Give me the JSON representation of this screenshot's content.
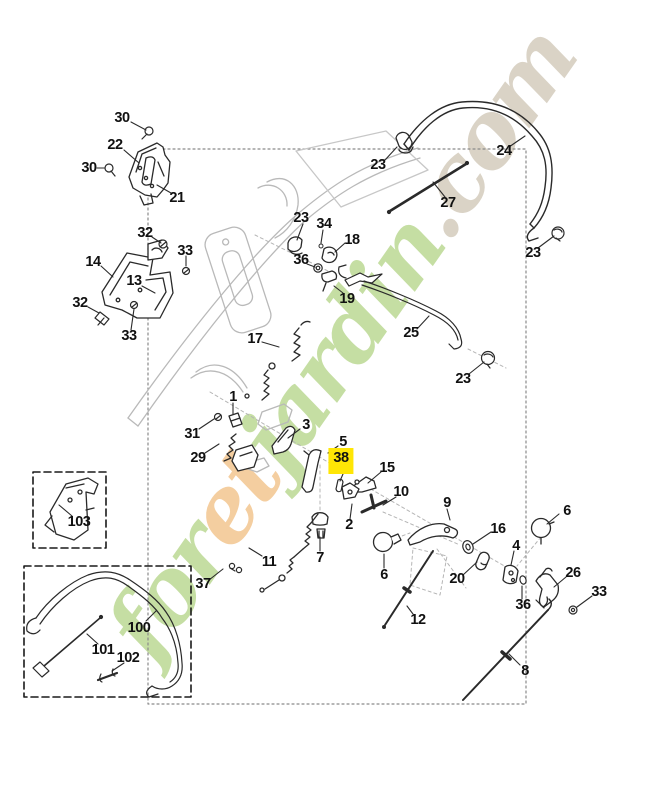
{
  "document": {
    "type": "exploded-parts-diagram",
    "subject": "lawnmower handle controls assembly"
  },
  "watermark": {
    "segments": [
      {
        "text": "for",
        "color": "#bcd994"
      },
      {
        "text": "et",
        "color": "#f3c690"
      },
      {
        "text": "jardin",
        "color": "#bcd994"
      },
      {
        "text": ".com",
        "color": "#d4ccbd"
      }
    ]
  },
  "colors": {
    "highlight": "#ffe605",
    "line": "#2a2a2a",
    "ghost": "#b7b7b7",
    "dashed_box": "#1a1a1a",
    "dotted_box": "#8a8a8a"
  },
  "diagram": {
    "highlighted_part": "38",
    "callouts": [
      {
        "label": "30",
        "x": 122,
        "y": 118
      },
      {
        "label": "22",
        "x": 115,
        "y": 145
      },
      {
        "label": "30",
        "x": 89,
        "y": 168
      },
      {
        "label": "21",
        "x": 177,
        "y": 198
      },
      {
        "label": "23",
        "x": 378,
        "y": 165
      },
      {
        "label": "24",
        "x": 504,
        "y": 151
      },
      {
        "label": "27",
        "x": 448,
        "y": 203
      },
      {
        "label": "32",
        "x": 145,
        "y": 233
      },
      {
        "label": "33",
        "x": 185,
        "y": 251
      },
      {
        "label": "14",
        "x": 93,
        "y": 262
      },
      {
        "label": "23",
        "x": 301,
        "y": 218
      },
      {
        "label": "34",
        "x": 324,
        "y": 224
      },
      {
        "label": "18",
        "x": 352,
        "y": 240
      },
      {
        "label": "36",
        "x": 301,
        "y": 260
      },
      {
        "label": "13",
        "x": 134,
        "y": 281
      },
      {
        "label": "32",
        "x": 80,
        "y": 303
      },
      {
        "label": "19",
        "x": 347,
        "y": 299
      },
      {
        "label": "33",
        "x": 129,
        "y": 336
      },
      {
        "label": "25",
        "x": 411,
        "y": 333
      },
      {
        "label": "23",
        "x": 533,
        "y": 253
      },
      {
        "label": "17",
        "x": 255,
        "y": 339
      },
      {
        "label": "23",
        "x": 463,
        "y": 379
      },
      {
        "label": "1",
        "x": 233,
        "y": 397
      },
      {
        "label": "31",
        "x": 192,
        "y": 434
      },
      {
        "label": "29",
        "x": 198,
        "y": 458
      },
      {
        "label": "3",
        "x": 306,
        "y": 425
      },
      {
        "label": "5",
        "x": 343,
        "y": 442
      },
      {
        "label": "38",
        "x": 341,
        "y": 461,
        "highlighted": true
      },
      {
        "label": "15",
        "x": 387,
        "y": 468
      },
      {
        "label": "10",
        "x": 401,
        "y": 492
      },
      {
        "label": "2",
        "x": 349,
        "y": 525
      },
      {
        "label": "9",
        "x": 447,
        "y": 503
      },
      {
        "label": "16",
        "x": 498,
        "y": 529
      },
      {
        "label": "6",
        "x": 567,
        "y": 511
      },
      {
        "label": "6",
        "x": 384,
        "y": 575
      },
      {
        "label": "20",
        "x": 457,
        "y": 579
      },
      {
        "label": "4",
        "x": 516,
        "y": 546
      },
      {
        "label": "36",
        "x": 523,
        "y": 605
      },
      {
        "label": "26",
        "x": 573,
        "y": 573
      },
      {
        "label": "33",
        "x": 599,
        "y": 592
      },
      {
        "label": "7",
        "x": 320,
        "y": 558
      },
      {
        "label": "11",
        "x": 269,
        "y": 562
      },
      {
        "label": "37",
        "x": 203,
        "y": 584
      },
      {
        "label": "12",
        "x": 418,
        "y": 620
      },
      {
        "label": "8",
        "x": 525,
        "y": 671
      },
      {
        "label": "103",
        "x": 79,
        "y": 522
      },
      {
        "label": "100",
        "x": 139,
        "y": 628
      },
      {
        "label": "101",
        "x": 103,
        "y": 650
      },
      {
        "label": "102",
        "x": 128,
        "y": 658
      }
    ]
  }
}
